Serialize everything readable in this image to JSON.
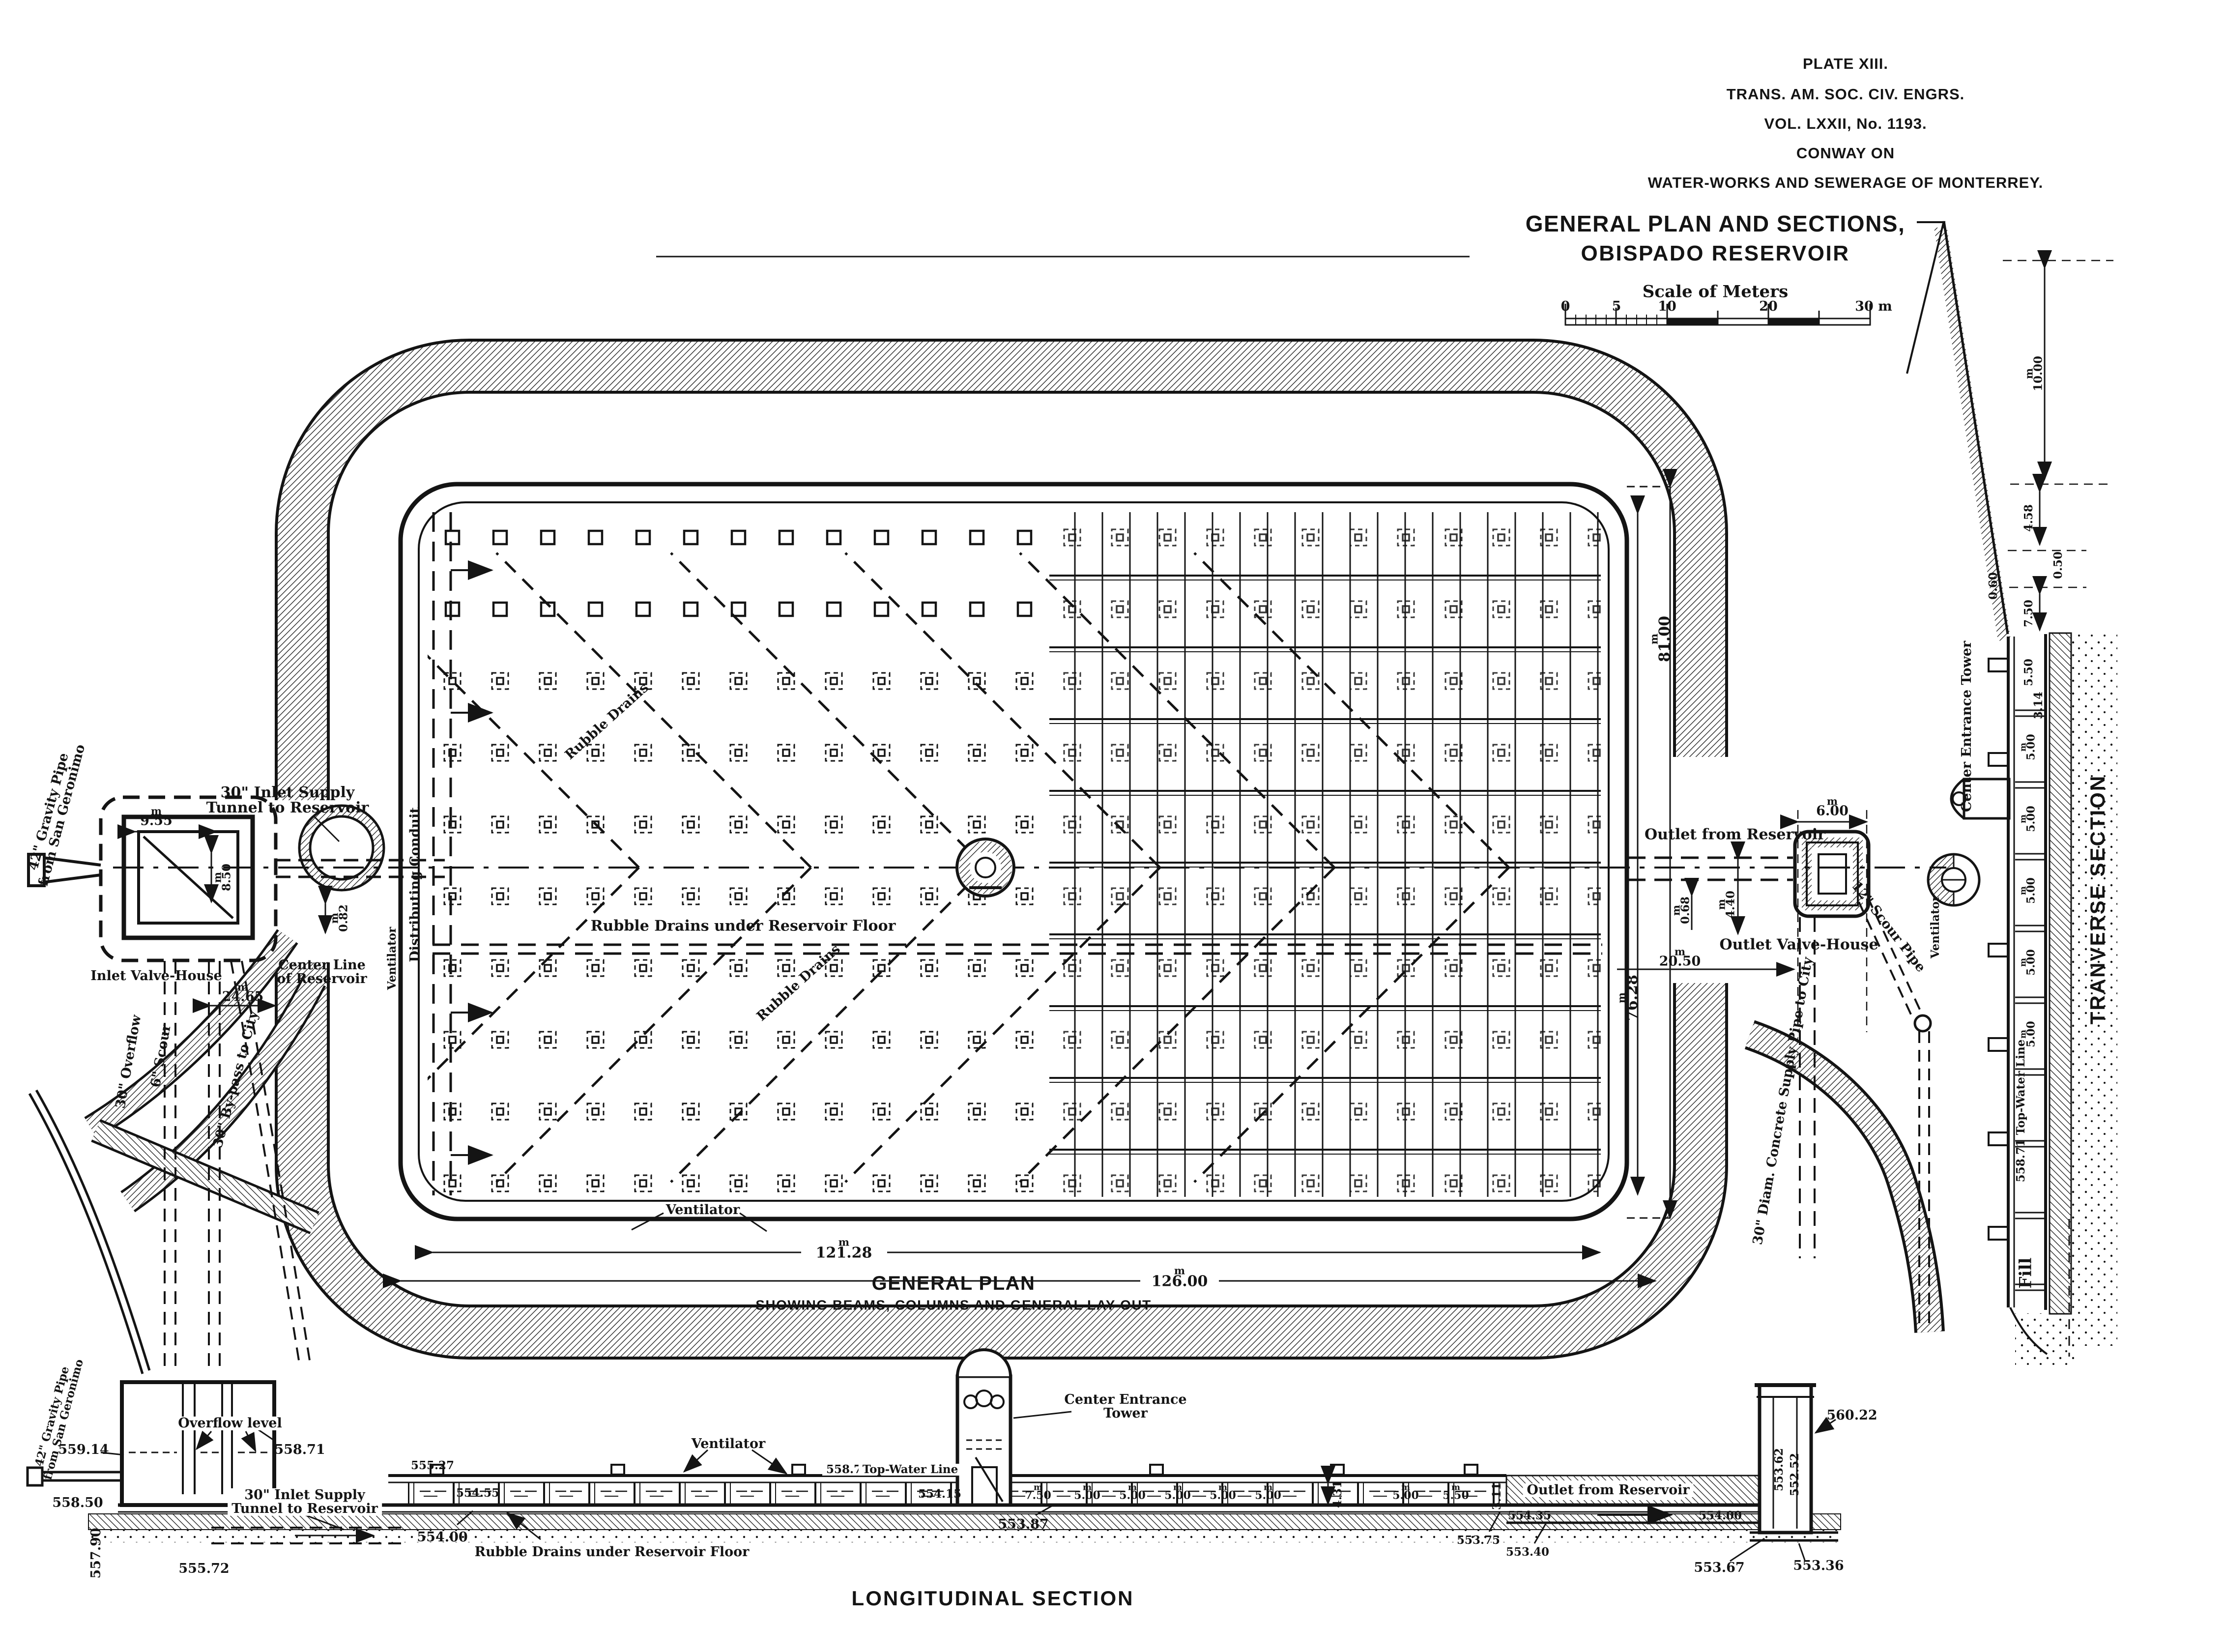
{
  "units": {
    "m": "m"
  },
  "title_block": {
    "plate": "PLATE XIII.",
    "society": "TRANS. AM. SOC. CIV. ENGRS.",
    "volume": "VOL. LXXII, No. 1193.",
    "author": "CONWAY ON",
    "work": "WATER-WORKS AND SEWERAGE OF MONTERREY."
  },
  "heading": {
    "title_line1": "GENERAL PLAN AND SECTIONS,",
    "title_line2": "OBISPADO RESERVOIR",
    "scale_caption": "Scale of Meters",
    "scale_ticks": [
      "0",
      "5",
      "10",
      "20",
      "30 m"
    ]
  },
  "captions": {
    "general_plan": "GENERAL PLAN",
    "general_plan_sub": "SHOWING BEAMS, COLUMNS AND GENERAL LAY-OUT",
    "longitudinal": "LONGITUDINAL SECTION",
    "transverse": "TRANVERSE SECTION"
  },
  "plan": {
    "labels": {
      "gravity_pipe1": "42\" Gravity Pipe",
      "gravity_pipe2": "from San Geronimo",
      "inlet_supply1": "30\" Inlet Supply",
      "inlet_supply2": "Tunnel to Reservoir",
      "inlet_valve_house": "Inlet Valve-House",
      "center_line1": "Center Line",
      "center_line2": "of Reservoir",
      "overflow": "30\" Overflow",
      "scour": "6\" Scour",
      "bypass": "30\" By-pass to City",
      "distributing_conduit": "Distributing Conduit",
      "ventilator_left": "Ventilator",
      "rubble_drains": "Rubble Drains",
      "rubble_drains_floor": "Rubble Drains under Reservoir Floor",
      "rubble_drains2": "Rubble Drains",
      "ventilator_bottom": "Ventilator",
      "outlet_from_reservoir": "Outlet from Reservoir",
      "outlet_valve_house": "Outlet Valve-House",
      "scour_pipe": "12\" Scour Pipe",
      "supply_pipe": "30\" Diam. Concrete Supply Pipe to City",
      "center_entrance_tower": "Center Entrance Tower",
      "ventilator_right": "Ventilator",
      "fill": "Fill"
    },
    "dims": {
      "valve_width": "9.55",
      "valve_height": "8.50",
      "offset": "0.82",
      "to_wall": "24.65",
      "len_outer": "81.00",
      "len_inner": "76.28",
      "outlet_width": "6.00",
      "outlet_offset": "0.68",
      "outlet_depth": "4.40",
      "outlet_dist": "20.50",
      "width_inner": "121.28",
      "width_outer": "126.00"
    }
  },
  "transverse": {
    "labels": {
      "top_water": "558.71 Top-Water Line"
    },
    "dims": {
      "bank_height": "10.00",
      "berm": "4.58",
      "d050": "0.50",
      "d060": "0.60",
      "slope": "7.50",
      "bay_a": "5.50",
      "bay_b": "3.14",
      "bay": "5.00"
    }
  },
  "longitudinal": {
    "labels": {
      "gravity_pipe1": "42\" Gravity Pipe",
      "gravity_pipe2": "from San Geronimo",
      "overflow_level": "Overflow level",
      "inlet_supply1": "30\" Inlet Supply",
      "inlet_supply2": "Tunnel to Reservoir",
      "ventilator": "Ventilator",
      "top_water": "Top-Water Line",
      "rubble": "Rubble Drains under Reservoir Floor",
      "center_tower1": "Center Entrance",
      "center_tower2": "Tower",
      "outlet": "Outlet from Reservoir"
    },
    "elevations": {
      "e559_14": "559.14",
      "e558_71": "558.71",
      "e558_50": "558.50",
      "e557_90": "557.90",
      "e555_72": "555.72",
      "e555_27": "555.27",
      "e554_55": "554.55",
      "e554_00": "554.00",
      "e558_71b": "558.71",
      "e554_15": "554.15",
      "e553_87": "553.87",
      "e553_75": "553.75",
      "e553_40": "553.40",
      "e554_35": "554.35",
      "e554_00b": "554.00",
      "e553_67": "553.67",
      "e553_36": "553.36",
      "e553_62": "553.62",
      "e552_52": "552.52",
      "e560_22": "560.22"
    },
    "bays": {
      "b750": "7.50",
      "b500": "5.00",
      "b550": "5.50",
      "b311": "3.11",
      "height": "4.31"
    }
  }
}
